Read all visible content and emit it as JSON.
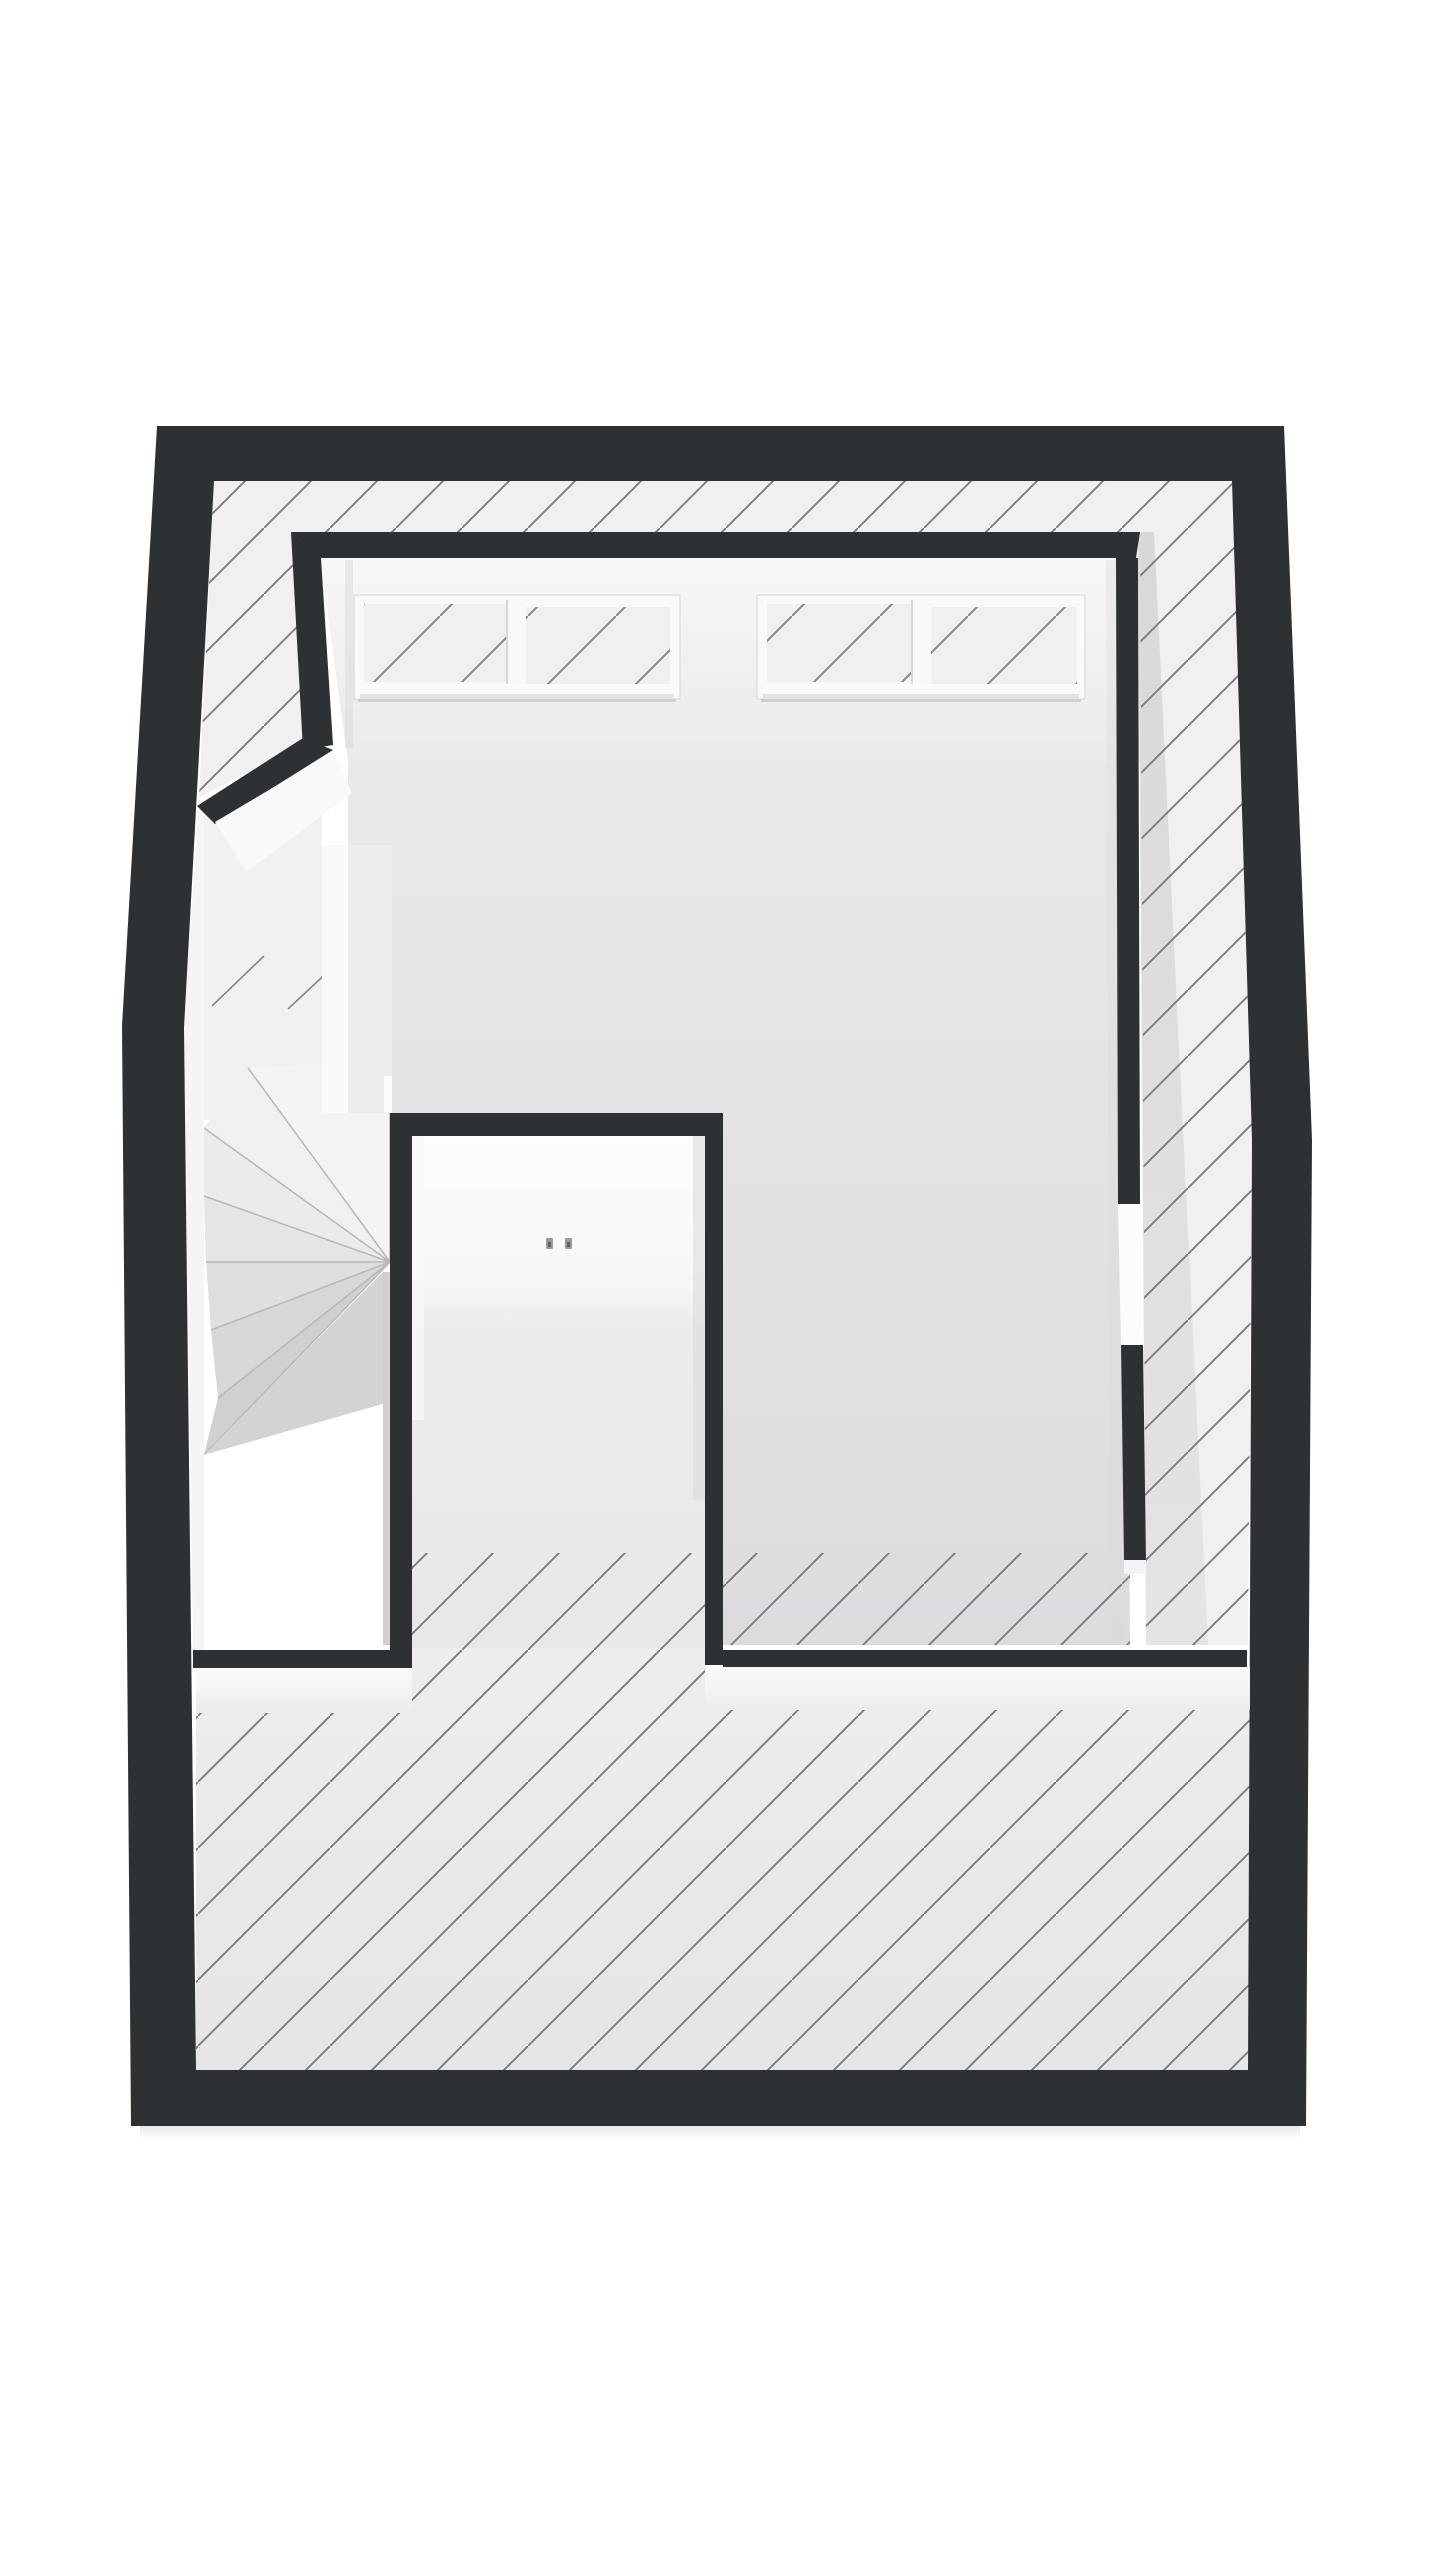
{
  "canvas": {
    "width": 1440,
    "height": 2560,
    "background": "#ffffff"
  },
  "colors": {
    "wall": "#2e3133",
    "hatch_line": "#77787b",
    "window_hatch_line": "#85878a",
    "strip_floor": "#f0f0f2",
    "room_floor_light": "#e9e9eb",
    "room_floor_dark": "#dcdcdf",
    "ceiling_light": "#f7f7f9",
    "ceiling_dark": "#eaeaec",
    "lower_floor_light": "#ededef",
    "lower_floor_dark": "#e5e5e7",
    "closet_back_wall": "#fdfdfe",
    "void": "#ffffff",
    "window_frame": "#f9f9fa",
    "glazing": "#eff0f2",
    "door_panel": "#fcfcfd",
    "handle": "#98989b",
    "handle_detail": "#606063",
    "wall_face_light": "#f5f5f7",
    "white_face": "#fafafb",
    "stair_tread_shades": [
      "#f4f4f6",
      "#f0f0f2",
      "#ebebed",
      "#e5e5e7",
      "#dfdfe1",
      "#d7d7d9",
      "#d0d0d2"
    ]
  },
  "floorplan": {
    "view": "3d-top-down",
    "windows_count": 2,
    "panes_per_window": 2,
    "door_handles_count": 2,
    "stair_winder_treads": 7,
    "hatch_angle_deg": 45
  }
}
